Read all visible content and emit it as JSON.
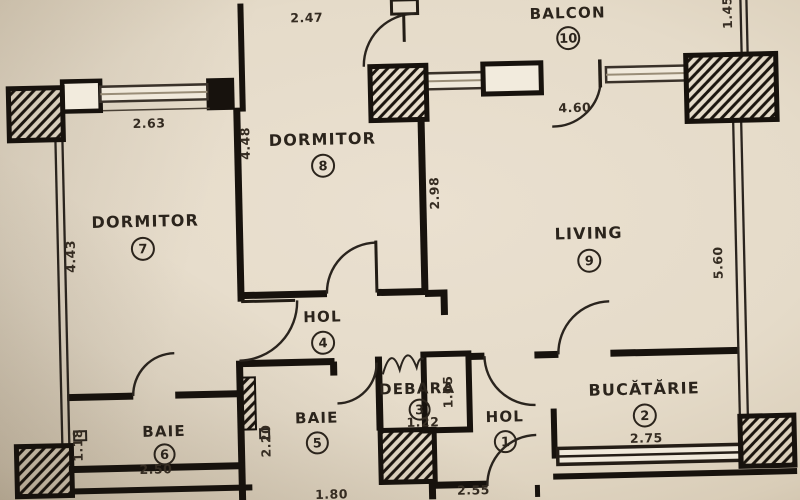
{
  "plan": {
    "rooms": [
      {
        "name": "BALCON",
        "number": "10"
      },
      {
        "name": "DORMITOR",
        "number": "8"
      },
      {
        "name": "DORMITOR",
        "number": "7"
      },
      {
        "name": "LIVING",
        "number": "9"
      },
      {
        "name": "HOL",
        "number": "4"
      },
      {
        "name": "DEBARA",
        "number": "3"
      },
      {
        "name": "BAIE",
        "number": "6"
      },
      {
        "name": "BAIE",
        "number": "5"
      },
      {
        "name": "HOL",
        "number": "1"
      },
      {
        "name": "BUCĂTĂRIE",
        "number": "2"
      }
    ],
    "dimensions": [
      "2.47",
      "1.45",
      "2.63",
      "4.48",
      "2.98",
      "4.60",
      "4.43",
      "5.60",
      "1.18",
      "2.50",
      "2.20",
      "1.80",
      "1.22",
      "1.05",
      "2.55",
      "2.75"
    ],
    "colors": {
      "paper": "#e5dbc9",
      "ink": "#17120d",
      "vignette": "#a99b81"
    }
  }
}
